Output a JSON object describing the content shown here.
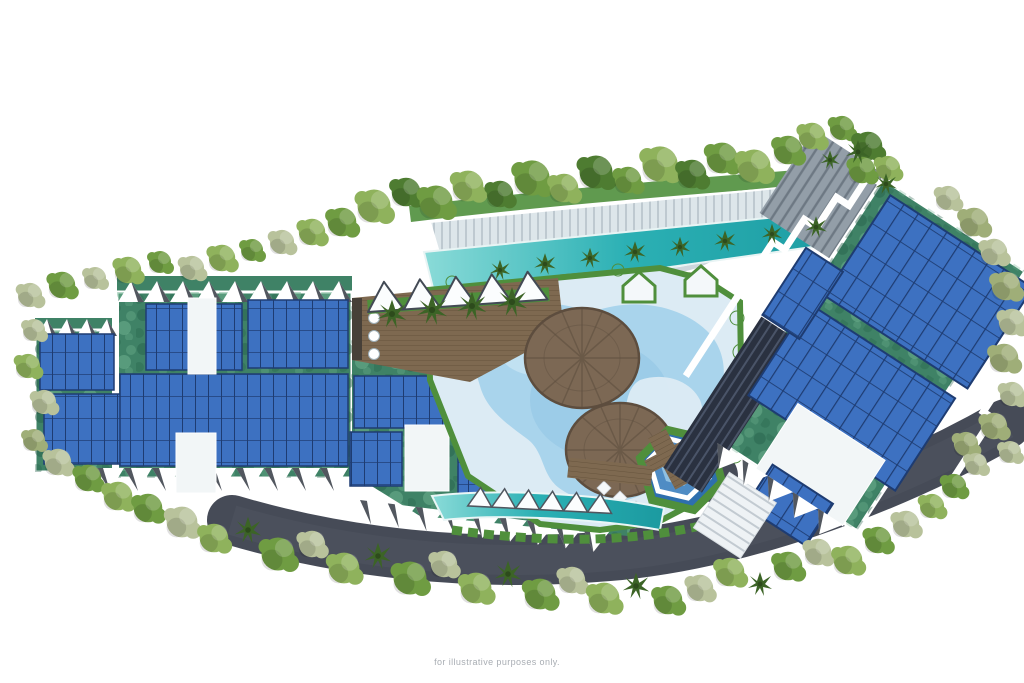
{
  "caption": "for illustrative purposes only.",
  "image_alt": "Aerial site plan rendering of a resort development: residential blocks with rooftop solar panels, central swimming pool deck with round canopy pavilions, lap pools, gardens, an access road and dense perimeter trees",
  "features": [
    "left residential block with solar roof",
    "central pool deck",
    "round canopy pavilions",
    "upper lap pool and promenade",
    "lower lap pool with sail shades",
    "hexagonal plunge pool",
    "right residential block with solar roof",
    "access road",
    "perimeter landscaping trees"
  ],
  "colors": {
    "panel": "#3d71c1",
    "panelGrid": "#1e3c72",
    "roof": "#3f8266",
    "hedge": "#4f8f3c",
    "treeGreen": "#6f9c42",
    "treeLight": "#8fb25c",
    "treeDark": "#4e7c31",
    "sage": "#b8c29b",
    "sageDark": "#9fae78",
    "palm": "#3c6426",
    "road": "#464b57",
    "water": "#a9d4ec",
    "waterDeep": "#8fc3e4",
    "poolDeep": "#2e6fae",
    "deck": "#dcebf4",
    "teal": "#2bb0b4",
    "tealLight": "#8adbd8",
    "wood": "#7e6950",
    "woodDark": "#66543d",
    "canopy": "#7c6854",
    "canopyDark": "#5d4d3e",
    "facade": "#2a3140",
    "caption": "#a8adb3"
  }
}
